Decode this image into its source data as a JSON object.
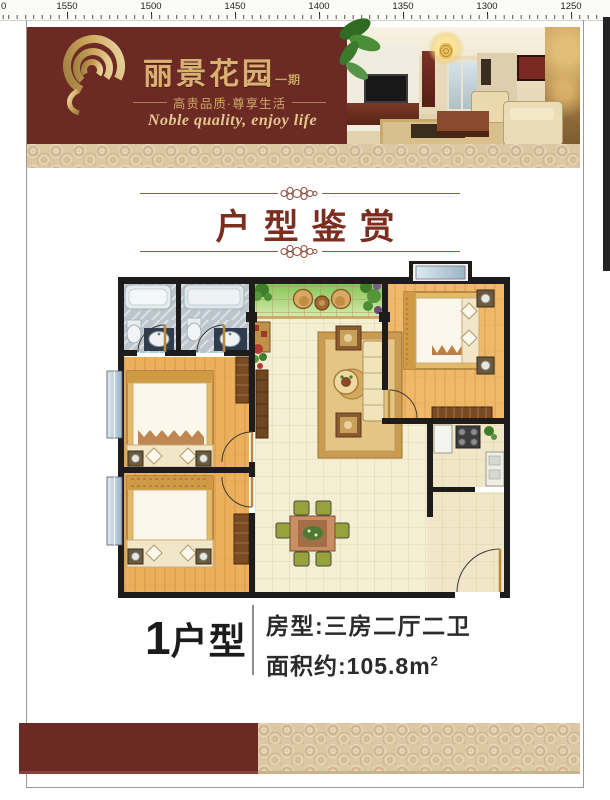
{
  "ruler": {
    "labels": [
      "1550",
      "1500",
      "1450",
      "1400",
      "1350",
      "1300",
      "1250"
    ],
    "edge_label": "0"
  },
  "header": {
    "brand": "丽景花园",
    "phase": "一期",
    "tagline_cn": "高贵品质·尊享生活",
    "tagline_en": "Noble quality, enjoy life"
  },
  "section_title": "户型鉴赏",
  "unit": {
    "no": "1",
    "word": "户型",
    "rooms_label": "房型:三房二厅二卫",
    "area_label": "面积约:105.8m",
    "area_exponent": "2"
  },
  "floor_plan": {
    "rooms": [
      "bathroom",
      "bathroom",
      "balcony",
      "master-bedroom",
      "living-room",
      "bedroom",
      "bedroom",
      "dining-area",
      "kitchen",
      "entry"
    ]
  },
  "colors": {
    "maroon": "#6b2a23",
    "gold": "#d9b071",
    "title_red": "#7c2d1e",
    "pattern_beige": "#dcc7a3",
    "wall_black": "#1e1c1a",
    "wood_floor": "#ecb05c",
    "tile_cream": "#f4eed3",
    "balcony_green": "#8cc95c",
    "bath_gray": "#bcc5cb",
    "glass_blue": "#c7d9e4"
  }
}
